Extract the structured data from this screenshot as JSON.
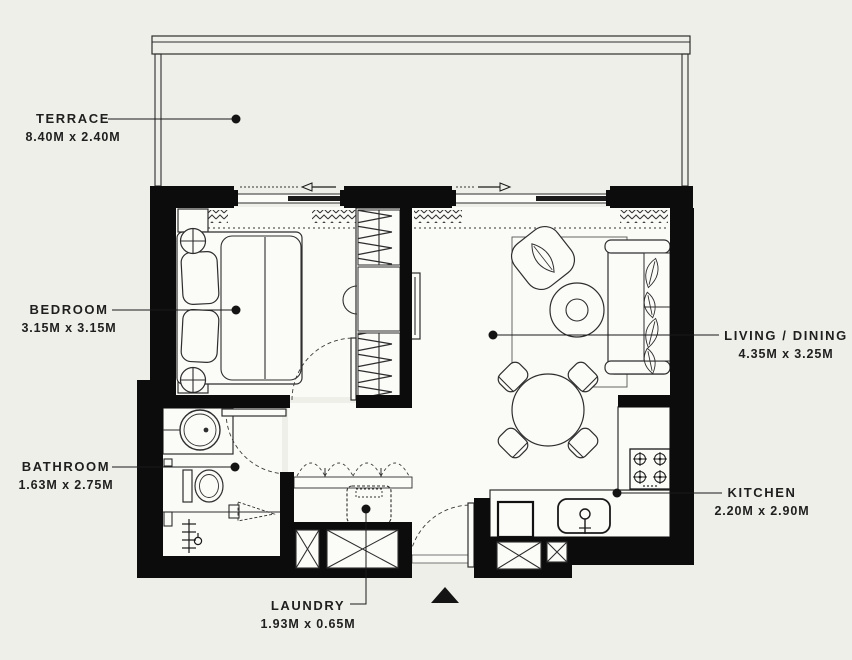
{
  "title": "Apartment floor plan",
  "colors": {
    "background": "#EFEFE9",
    "floor": "#FAFAF6",
    "wall": "#0C0C0C",
    "line": "#2E2E2E",
    "label_text": "#1F1F1F"
  },
  "rooms": {
    "terrace": {
      "label": "TERRACE",
      "dimensions": "8.40M x 2.40M"
    },
    "bedroom": {
      "label": "BEDROOM",
      "dimensions": "3.15M x 3.15M"
    },
    "living_dining": {
      "label": "LIVING / DINING",
      "dimensions": "4.35M x 3.25M"
    },
    "bathroom": {
      "label": "BATHROOM",
      "dimensions": "1.63M x 2.75M"
    },
    "kitchen": {
      "label": "KITCHEN",
      "dimensions": "2.20M x 2.90M"
    },
    "laundry": {
      "label": "LAUNDRY",
      "dimensions": "1.93M x 0.65M"
    }
  },
  "markers": {
    "entrance": "entrance-arrow"
  }
}
